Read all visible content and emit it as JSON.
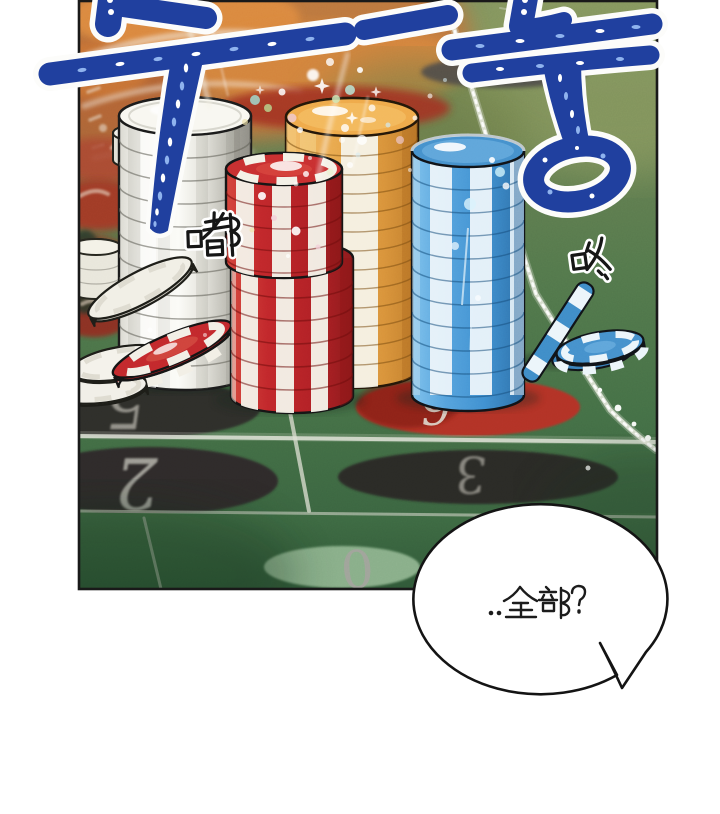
{
  "scene": {
    "description": "Webtoon panel: tall stacks of casino chips piled on a roulette betting layout, low angle view across the felt",
    "panel_border_color": "#191919",
    "background_color": "#ffffff"
  },
  "sfx": {
    "korean": [
      {
        "id": "doo",
        "text": "두",
        "color": "#20409f",
        "outline": "#ffffff"
      },
      {
        "id": "doong",
        "text": "둥",
        "color": "#20409f",
        "outline": "#ffffff"
      }
    ],
    "chinese": [
      {
        "id": "du",
        "text": "嘟",
        "color": "#161616",
        "outline": "#ffffff"
      },
      {
        "id": "dong",
        "text": "咚",
        "color": "#161616",
        "outline": "#ffffff"
      }
    ]
  },
  "speech_bubble": {
    "text": "..全部?",
    "fill": "#ffffff",
    "stroke": "#141414",
    "text_color": "#1c1c1c"
  },
  "table": {
    "numbers": [
      "5",
      "2",
      "6",
      "3",
      "0"
    ],
    "ovals": [
      {
        "number": "5",
        "fill": "#2f2d2a",
        "number_color": "#9b9992"
      },
      {
        "number": "2",
        "fill": "#2e2c29",
        "number_color": "#a9a7a0"
      },
      {
        "number": "6",
        "fill": "#b23227",
        "number_color": "#ded6cb"
      },
      {
        "number": "3",
        "fill": "#2c2a27",
        "number_color": "#8e8c85"
      },
      {
        "number": "0",
        "fill": "#88ae89",
        "number_color": "#a2a39c"
      }
    ],
    "felt_color": "#4a7449",
    "line_color": "#e8eadf",
    "wheel_blur_color": "#c67a42"
  },
  "chips": {
    "stacks": [
      {
        "name": "white-stack",
        "color": "#f2f1ea"
      },
      {
        "name": "orange-stack",
        "color": "#efa94a",
        "stripe": "#f6f3e8"
      },
      {
        "name": "red-striped-stack",
        "color": "#c1272b",
        "stripe": "#f4f1e7"
      },
      {
        "name": "blue-striped-stack",
        "color": "#4590cc",
        "stripe": "#eaf4fa"
      }
    ],
    "loose": [
      {
        "name": "tilted-red-chip",
        "color": "#c2282c"
      },
      {
        "name": "leaning-white-chip",
        "color": "#f1efe6"
      },
      {
        "name": "small-white-chips",
        "color": "#f1efe8"
      },
      {
        "name": "leaning-blue-chip",
        "color": "#3f8cc8"
      },
      {
        "name": "flat-blue-chip",
        "color": "#4590cc"
      }
    ]
  }
}
